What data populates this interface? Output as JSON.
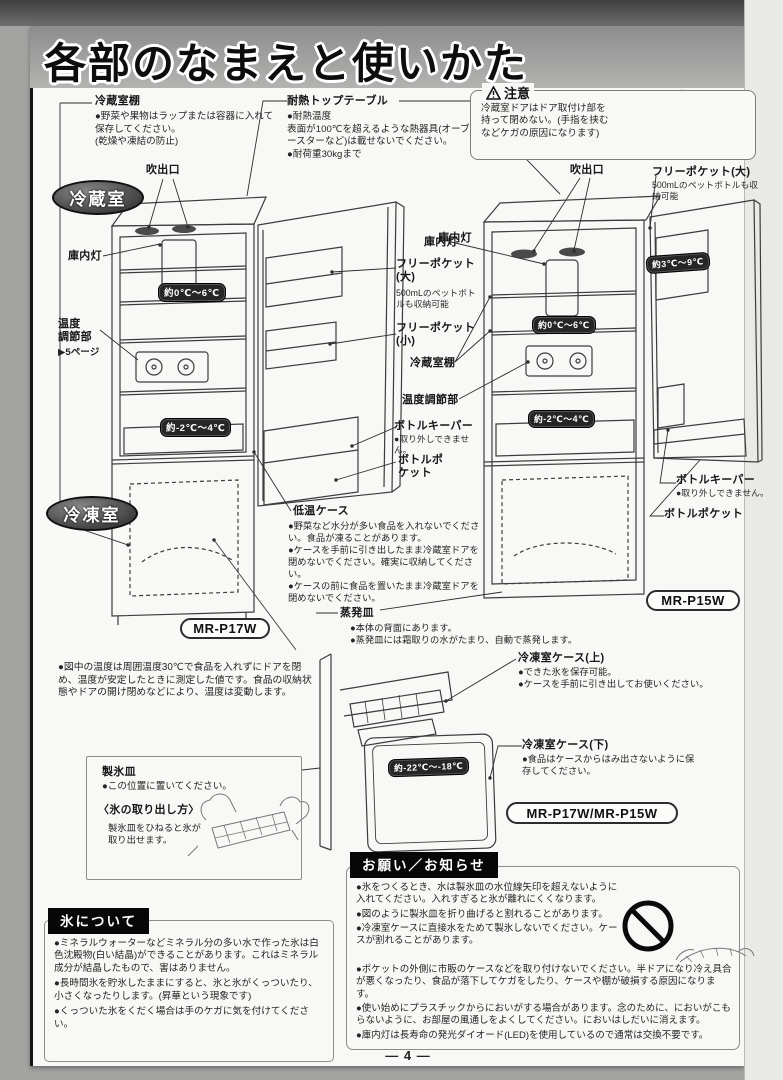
{
  "page": {
    "title": "各部のなまえと使いかた",
    "page_number": "― 4 ―"
  },
  "compartments": {
    "fridge": "冷蔵室",
    "freezer": "冷凍室"
  },
  "models": {
    "left": "MR-P17W",
    "right": "MR-P15W",
    "combined": "MR-P17W/MR-P15W"
  },
  "caution": {
    "title": "注意",
    "body": "冷蔵室ドアはドア取付け部を持って閉めない。(手指を挟むなどケガの原因になります)"
  },
  "top_labels": {
    "fridge_shelf_title": "冷蔵室棚",
    "fridge_shelf_body": "●野菜や果物はラップまたは容器に入れて保存してください。\n(乾燥や凍結の防止)",
    "heat_table_title": "耐熱トップテーブル",
    "heat_table_body": "●耐熱温度\n表面が100℃を超えるような熱器具(オーブントースターなど)は載せないでください。\n●耐荷重30kgまで"
  },
  "left_diagram": {
    "outlet": "吹出口",
    "lamp": "庫内灯",
    "temp_mid": "約0℃～6℃",
    "temp_ctrl_title": "温度\n調節部",
    "temp_ctrl_ref": "▶5ページ",
    "temp_low": "約-2℃～4℃"
  },
  "mid_labels": {
    "lamp": "庫内灯",
    "free_pocket_large_title": "フリーポケット(大)",
    "free_pocket_large_body": "500mLのペットボトルも収納可能",
    "free_pocket_small": "フリーポケット(小)",
    "fridge_shelf": "冷蔵室棚",
    "temp_ctrl": "温度調節部",
    "bottle_keeper_title": "ボトルキーパー",
    "bottle_keeper_body": "●取り外しできません。",
    "bottle_pocket": "ボトルポケット",
    "low_temp_case_title": "低温ケース",
    "low_temp_case_body": "●野菜など水分が多い食品を入れないでください。食品が凍ることがあります。\n●ケースを手前に引き出したまま冷蔵室ドアを閉めないでください。確実に収納してください。\n●ケースの前に食品を置いたまま冷蔵室ドアを閉めないでください。",
    "evap_title": "蒸発皿",
    "evap_body": "●本体の背面にあります。\n●蒸発皿には霜取りの水がたまり、自動で蒸発します。"
  },
  "right_diagram": {
    "outlet": "吹出口",
    "free_pocket_large_title": "フリーポケット(大)",
    "free_pocket_large_body": "500mLのペットボトルも収納可能",
    "lamp": "庫内灯",
    "temp_door": "約3℃～9℃",
    "temp_mid": "約0℃～6℃",
    "temp_low": "約-2℃～4℃",
    "bottle_keeper_title": "ボトルキーパー",
    "bottle_keeper_body": "●取り外しできません。",
    "bottle_pocket": "ボトルポケット"
  },
  "temp_note": "●図中の温度は周囲温度30℃で食品を入れずにドアを閉め、温度が安定したときに測定した値です。食品の収納状態やドアの開け閉めなどにより、温度は変動します。",
  "ice_tray_box": {
    "title": "製氷皿",
    "body": "●この位置に置いてください。",
    "how_title": "〈氷の取り出し方〉",
    "how_body": "製氷皿をひねると氷が取り出せます。"
  },
  "freezer_diagram": {
    "upper_title": "冷凍室ケース(上)",
    "upper_body": "●できた氷を保存可能。\n●ケースを手前に引き出してお使いください。",
    "lower_title": "冷凍室ケース(下)",
    "lower_body": "●食品はケースからはみ出さないように保存してください。",
    "temp": "約-22℃～-18℃"
  },
  "ice_section": {
    "title": "氷について",
    "items": [
      "●ミネラルウォーターなどミネラル分の多い水で作った氷は白色沈殿物(白い結晶)ができることがあります。これはミネラル成分が結晶したもので、害はありません。",
      "●長時間氷を貯氷したままにすると、氷と氷がくっついたり、小さくなったりします。(昇華という現象です)",
      "●くっついた氷をくだく場合は手のケガに気を付けてください。"
    ]
  },
  "notice_section": {
    "title": "お願い／お知らせ",
    "items": [
      "●氷をつくるとき、水は製氷皿の水位線矢印を超えないように入れてください。入れすぎると氷が離れにくくなります。",
      "●図のように製氷皿を折り曲げると割れることがあります。",
      "●冷凍室ケースに直接水をためて製氷しないでください。ケースが割れることがあります。",
      "●ポケットの外側に市販のケースなどを取り付けないでください。半ドアになり冷え具合が悪くなったり、食品が落下してケガをしたり、ケースや棚が破損する原因になります。",
      "●使い始めにプラスチックからにおいがする場合があります。念のために、においがこもらないように、お部屋の風通しをよくしてください。においはしだいに消えます。",
      "●庫内灯は長寿命の発光ダイオード(LED)を使用しているので通常は交換不要です。"
    ]
  },
  "colors": {
    "badge_dark": "#262626",
    "header_black": "#070707",
    "band_gray": "#9b9b9b"
  }
}
